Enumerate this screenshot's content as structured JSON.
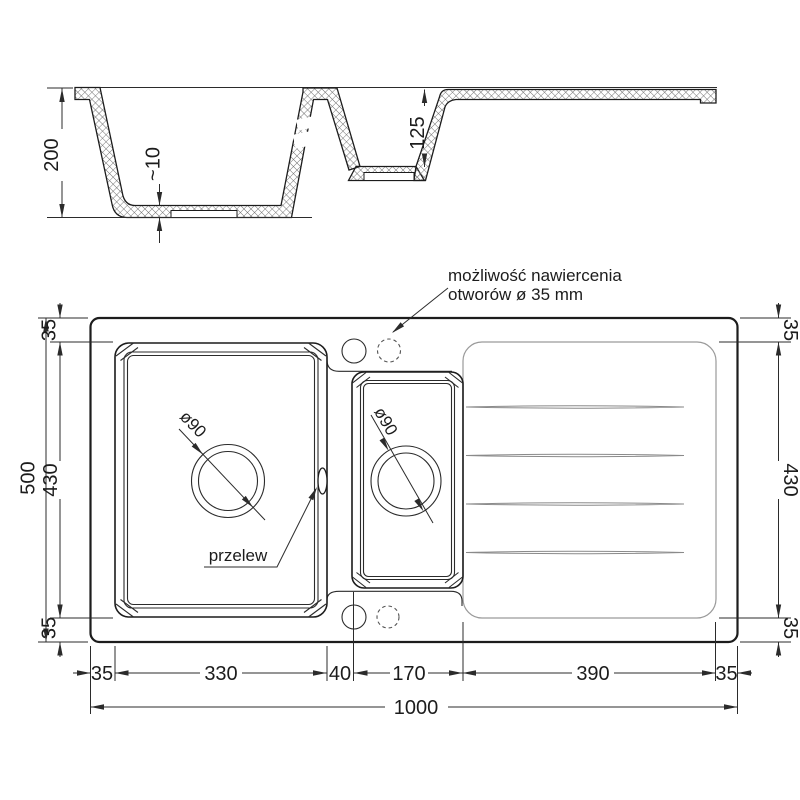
{
  "drawing_type": "kitchen sink technical drawing",
  "colors": {
    "line": "#1c1c1c",
    "dimension_line": "#2b2b2b",
    "light_line": "#9a9a9a",
    "hatch": "#6e6e6e",
    "background": "#ffffff"
  },
  "side_view": {
    "overall_depth": "200",
    "base_thickness": "~10",
    "small_bowl_depth": "125"
  },
  "top_view": {
    "note_line1": "możliwość nawiercenia",
    "note_line2": "otworów ø 35 mm",
    "overflow_label": "przelew",
    "main_drain_diameter": "ø90",
    "small_drain_diameter": "ø90",
    "overall_width": "1000",
    "overall_height": "500",
    "left_chain": {
      "top": "35",
      "middle": "430",
      "bottom": "35"
    },
    "right_chain": {
      "top": "35",
      "middle": "430",
      "bottom": "35"
    },
    "bottom_chain": {
      "left_rim": "35",
      "main_bowl": "330",
      "divider": "40",
      "small_bowl": "170",
      "drainer": "390",
      "right_rim": "35"
    }
  }
}
